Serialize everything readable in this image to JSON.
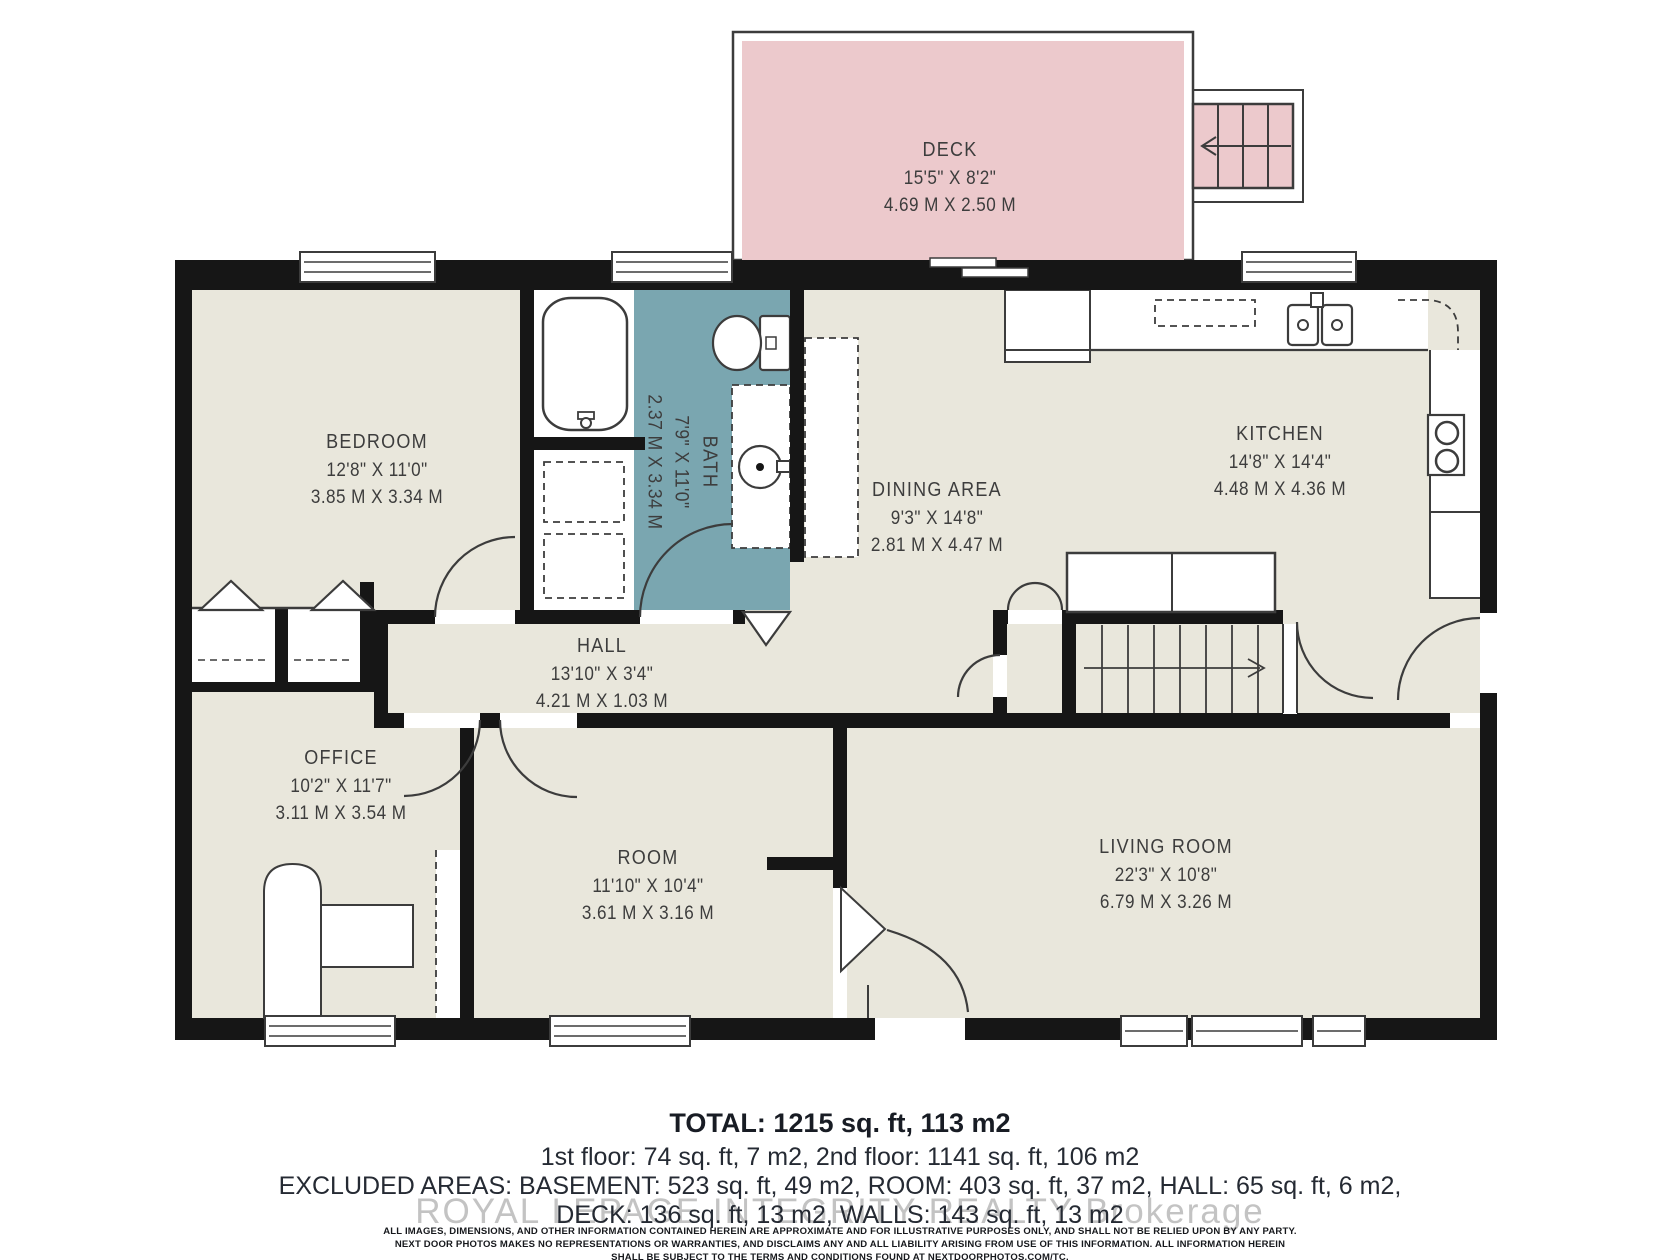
{
  "colors": {
    "deck_fill": "#ecc9cc",
    "floor_fill": "#e9e7dc",
    "bath_fill": "#7aa6b0",
    "wall": "#161616",
    "line": "#3c3c3c",
    "label_text": "#3d3d3d",
    "watermark": "#c3c3c3"
  },
  "rooms": [
    {
      "id": "deck",
      "name": "DECK",
      "dims": "15'5\" X 8'2\"",
      "meters": "4.69 M X 2.50 M"
    },
    {
      "id": "bedroom",
      "name": "BEDROOM",
      "dims": "12'8\" X 11'0\"",
      "meters": "3.85 M X 3.34 M"
    },
    {
      "id": "bath",
      "name": "BATH",
      "dims": "7'9\" X 11'0\"",
      "meters": "2.37 M X 3.34 M"
    },
    {
      "id": "dining",
      "name": "DINING AREA",
      "dims": "9'3\" X 14'8\"",
      "meters": "2.81 M X 4.47 M"
    },
    {
      "id": "kitchen",
      "name": "KITCHEN",
      "dims": "14'8\" X 14'4\"",
      "meters": "4.48 M X 4.36 M"
    },
    {
      "id": "hall",
      "name": "HALL",
      "dims": "13'10\" X 3'4\"",
      "meters": "4.21 M X 1.03 M"
    },
    {
      "id": "office",
      "name": "OFFICE",
      "dims": "10'2\" X 11'7\"",
      "meters": "3.11 M X 3.54 M"
    },
    {
      "id": "room",
      "name": "ROOM",
      "dims": "11'10\" X 10'4\"",
      "meters": "3.61 M X 3.16 M"
    },
    {
      "id": "living",
      "name": "LIVING ROOM",
      "dims": "22'3\" X 10'8\"",
      "meters": "6.79 M X 3.26 M"
    }
  ],
  "summary": {
    "total": "TOTAL: 1215 sq. ft, 113 m2",
    "floors": "1st floor: 74 sq. ft, 7 m2, 2nd floor: 1141 sq. ft, 106 m2",
    "excluded_line1": "EXCLUDED AREAS: BASEMENT: 523 sq. ft, 49 m2, ROOM: 403 sq. ft, 37 m2, HALL: 65 sq. ft, 6 m2,",
    "excluded_line2": "DECK: 136 sq. ft, 13 m2, WALLS: 143 sq. ft, 13 m2"
  },
  "watermark": "ROYAL LEPAGE INTEGRITY REALTY Brokerage",
  "disclaimer": {
    "line1": "ALL IMAGES, DIMENSIONS, AND OTHER INFORMATION CONTAINED HEREIN ARE APPROXIMATE AND FOR ILLUSTRATIVE PURPOSES ONLY, AND SHALL NOT BE RELIED UPON BY ANY PARTY.",
    "line2": "NEXT DOOR PHOTOS MAKES NO REPRESENTATIONS OR WARRANTIES, AND DISCLAIMS ANY AND ALL LIABILITY ARISING FROM USE OF THIS INFORMATION. ALL INFORMATION HEREIN",
    "line3": "SHALL BE SUBJECT TO THE TERMS AND CONDITIONS FOUND AT NEXTDOORPHOTOS.COM/TC."
  }
}
